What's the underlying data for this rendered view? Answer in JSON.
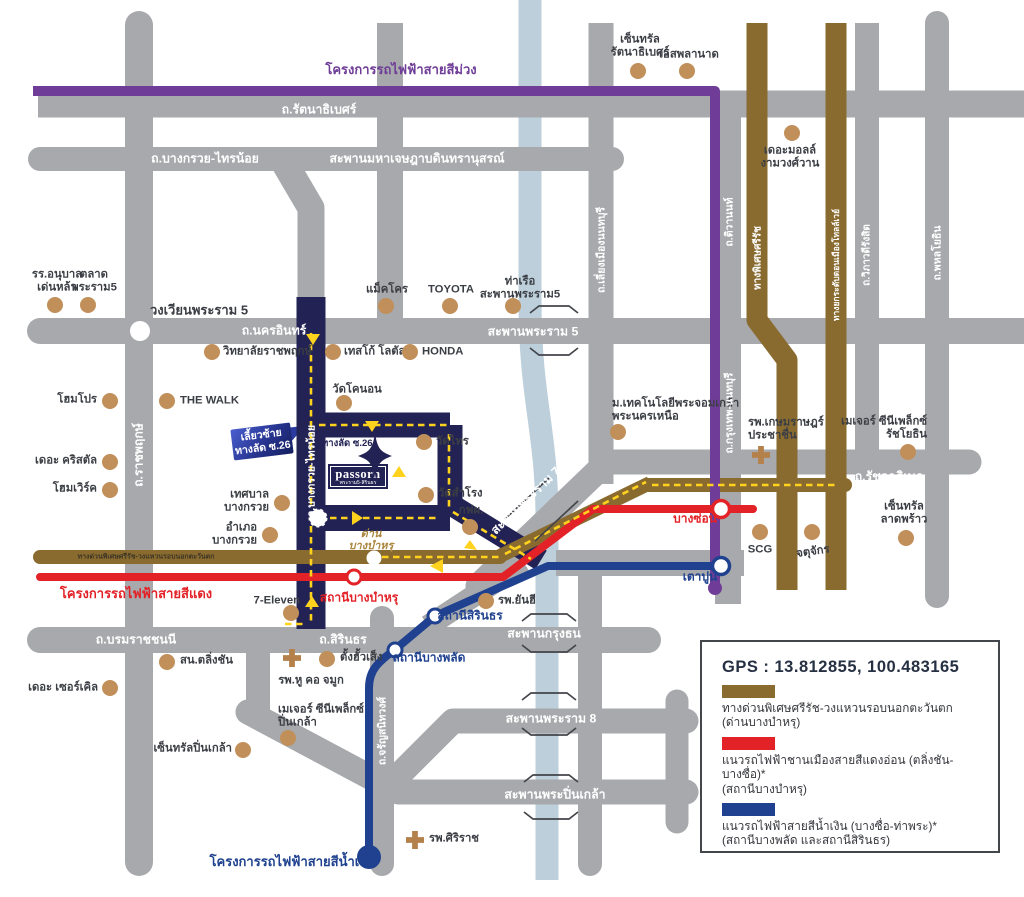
{
  "colors": {
    "road_gray": "#a7a9ac",
    "road_navy": "#222254",
    "expressway_brown": "#8a6b2f",
    "red_line": "#e32228",
    "blue_line": "#1f418f",
    "purple_line": "#6f3d97",
    "river": "#bccfda",
    "poi_dot": "#c18f5a",
    "gold": "#ab873e",
    "route_yellow": "#ffd21e",
    "text_dark": "#3b3e44"
  },
  "legend": {
    "gps": "GPS : 13.812855, 100.483165",
    "items": [
      {
        "color": "#8a6b2f",
        "text": "ทางด่วนพิเศษศรีรัช-วงแหวนรอบนอกตะวันตก\n(ด่านบางบำหรุ)"
      },
      {
        "color": "#e32228",
        "text": "แนวรถไฟฟ้าชานเมืองสายสีแดงอ่อน (ตลิ่งชัน-บางซื่อ)*\n(สถานีบางบำหรุ)"
      },
      {
        "color": "#1f418f",
        "text": "แนวรถไฟฟ้าสายสีน้ำเงิน (บางซื่อ-ท่าพระ)*\n(สถานีบางพลัด และสถานีสิรินธร)"
      }
    ]
  },
  "logo": {
    "name": "passorn",
    "subtitle": "พระราม5-สิรินธร"
  },
  "callout": {
    "line1": "เลี้ยวซ้าย",
    "line2": "ทางลัด ซ.26"
  },
  "shortcut_road_label": "ทางลัด ซ.26",
  "road_labels": [
    {
      "t": "ถ.รัตนาธิเบศร์",
      "x": 319,
      "y": 110
    },
    {
      "t": "ถ.บางกรวย-ไทรน้อย",
      "x": 205,
      "y": 159
    },
    {
      "t": "สะพานมหาเจษฎาบดินทรานุสรณ์",
      "x": 417,
      "y": 159
    },
    {
      "t": "วงเวียนพระราม 5",
      "x": 199,
      "y": 310,
      "c": "#3b3e44",
      "fs": 13
    },
    {
      "t": "ถ.นครอินทร์",
      "x": 274,
      "y": 331
    },
    {
      "t": "สะพานพระราม 5",
      "x": 533,
      "y": 332
    },
    {
      "t": "ถ.รัชดาภิเษก",
      "x": 889,
      "y": 477
    },
    {
      "t": "ถ.บรมราชชนนี",
      "x": 136,
      "y": 640
    },
    {
      "t": "ถ.สิรินธร",
      "x": 343,
      "y": 640
    },
    {
      "t": "สะพานกรุงธน",
      "x": 544,
      "y": 634
    },
    {
      "t": "สะพานพระราม 8",
      "x": 551,
      "y": 719
    },
    {
      "t": "สะพานพระปิ่นเกล้า",
      "x": 555,
      "y": 795
    },
    {
      "t": "สะพานพระราม 7",
      "x": 526,
      "y": 501,
      "rot": -44
    },
    {
      "t": "ถ.ราชพฤกษ์",
      "x": 139,
      "y": 455,
      "rot": -90
    },
    {
      "t": "ถ.บางกรวย-ไทรน้อย",
      "x": 311,
      "y": 471,
      "rot": -90,
      "fs": 10.5
    },
    {
      "t": "ถ.เลี่ยงเมืองนนทบุรี",
      "x": 601,
      "y": 250,
      "rot": -90,
      "fs": 10.5
    },
    {
      "t": "ถ.ติวานนท์",
      "x": 729,
      "y": 222,
      "rot": -90,
      "fs": 10.5
    },
    {
      "t": "ถ.กรุงเทพ-นนทบุรี",
      "x": 729,
      "y": 413,
      "rot": -90,
      "fs": 10.5
    },
    {
      "t": "ทางพิเศษศรีรัช",
      "x": 758,
      "y": 258,
      "rot": -90,
      "fs": 10
    },
    {
      "t": "ทางยกระดับดอนเมืองโทลล์เวย์",
      "x": 836,
      "y": 265,
      "rot": -90,
      "fs": 8.5
    },
    {
      "t": "ถ.วิภาวดีรังสิต",
      "x": 867,
      "y": 255,
      "rot": -90,
      "fs": 10
    },
    {
      "t": "ถ.พหลโยธิน",
      "x": 937,
      "y": 253,
      "rot": -90,
      "fs": 10.5
    },
    {
      "t": "ถ.จรัญสนิทวงศ์",
      "x": 382,
      "y": 731,
      "rot": -90,
      "fs": 10.5
    },
    {
      "t": "ทางด่วนพิเศษศรีรัช-วงแหวนรอบนอกตะวันตก",
      "x": 146,
      "y": 557,
      "c": "#3c3526",
      "fs": 7
    }
  ],
  "transit_labels": [
    {
      "t": "โครงการรถไฟฟ้าสายสีม่วง",
      "x": 401,
      "y": 70,
      "c": "#6f3d97",
      "fs": 13
    },
    {
      "t": "โครงการรถไฟฟ้าสายสีแดง",
      "x": 136,
      "y": 594,
      "c": "#e32228",
      "fs": 13
    },
    {
      "t": "โครงการรถไฟฟ้าสายสีน้ำเงิน",
      "x": 292,
      "y": 862,
      "c": "#1f418f",
      "fs": 13
    },
    {
      "t": "บางซ่อน",
      "x": 695,
      "y": 519,
      "c": "#e32228"
    },
    {
      "t": "เตาปูน",
      "x": 700,
      "y": 577,
      "c": "#1f418f"
    },
    {
      "t": "สถานีบางบำหรุ",
      "x": 359,
      "y": 598,
      "c": "#e32228"
    },
    {
      "t": "สถานีสิรินธร",
      "x": 470,
      "y": 616,
      "c": "#1f418f"
    },
    {
      "t": "สถานีบางพลัด",
      "x": 429,
      "y": 658,
      "c": "#1f418f"
    },
    {
      "t": "ด่าน\nบางบำหรุ",
      "x": 371,
      "y": 540,
      "c": "#ab873e",
      "fs": 11,
      "i": true
    }
  ],
  "pois": [
    {
      "t": "รร.อนุบาล\nเด่นหล้า",
      "x": 55,
      "y": 305,
      "lx": 57,
      "ly": 281,
      "a": "c"
    },
    {
      "t": "ตลาด\nพระราม5",
      "x": 88,
      "y": 305,
      "lx": 94,
      "ly": 281,
      "a": "c"
    },
    {
      "t": "แม็คโคร",
      "x": 386,
      "y": 306,
      "lx": 387,
      "ly": 290,
      "a": "c"
    },
    {
      "t": "TOYOTA",
      "x": 450,
      "y": 306,
      "lx": 451,
      "ly": 290,
      "a": "c"
    },
    {
      "t": "ท่าเรือ\nสะพานพระราม5",
      "x": 513,
      "y": 306,
      "lx": 520,
      "ly": 288,
      "a": "c"
    },
    {
      "t": "เซ็นทรัล\nรัตนาธิเบศร์",
      "x": 638,
      "y": 71,
      "lx": 640,
      "ly": 46,
      "a": "c"
    },
    {
      "t": "เอสพลานาด",
      "x": 687,
      "y": 71,
      "lx": 689,
      "ly": 55,
      "a": "c"
    },
    {
      "t": "เดอะมอลล์\nงามวงศ์วาน",
      "x": 792,
      "y": 133,
      "lx": 790,
      "ly": 157,
      "a": "c"
    },
    {
      "t": "วิทยาลัยราชพฤกษ์",
      "x": 212,
      "y": 352,
      "lx": 223,
      "ly": 352,
      "a": "l"
    },
    {
      "t": "เทสโก้ โลตัส",
      "x": 333,
      "y": 352,
      "lx": 344,
      "ly": 352,
      "a": "l"
    },
    {
      "t": "HONDA",
      "x": 410,
      "y": 352,
      "lx": 422,
      "ly": 352,
      "a": "l"
    },
    {
      "t": "วัดโคนอน",
      "x": 344,
      "y": 403,
      "lx": 357,
      "ly": 390,
      "a": "c"
    },
    {
      "t": "โฮมโปร",
      "x": 110,
      "y": 401,
      "lx": 97,
      "ly": 400,
      "a": "r"
    },
    {
      "t": "THE WALK",
      "x": 167,
      "y": 401,
      "lx": 180,
      "ly": 401,
      "a": "l"
    },
    {
      "t": "เดอะ คริสตัล",
      "x": 110,
      "y": 462,
      "lx": 97,
      "ly": 461,
      "a": "r"
    },
    {
      "t": "โฮมเวิร์ค",
      "x": 110,
      "y": 490,
      "lx": 97,
      "ly": 489,
      "a": "r"
    },
    {
      "t": "เทศบาล\nบางกรวย",
      "x": 282,
      "y": 503,
      "lx": 269,
      "ly": 501,
      "a": "r"
    },
    {
      "t": "อำเภอ\nบางกรวย",
      "x": 270,
      "y": 535,
      "lx": 257,
      "ly": 534,
      "a": "r"
    },
    {
      "t": "วัดไทร",
      "x": 424,
      "y": 442,
      "lx": 436,
      "ly": 442,
      "a": "l"
    },
    {
      "t": "วัดสำโรง",
      "x": 426,
      "y": 495,
      "lx": 438,
      "ly": 494,
      "a": "l"
    },
    {
      "t": "กฟผ.",
      "x": 470,
      "y": 527,
      "lx": 471,
      "ly": 511,
      "a": "c"
    },
    {
      "t": "ม.เทคโนโลยีพระจอมเกล้า\nพระนครเหนือ",
      "x": 618,
      "y": 432,
      "lx": 612,
      "ly": 410,
      "a": "l"
    },
    {
      "t": "รพ.เกษมราษฎร์\nประชาชื่น",
      "x": 761,
      "y": 455,
      "lx": 748,
      "ly": 429,
      "a": "l",
      "type": "cross"
    },
    {
      "t": "เมเจอร์ ซีนีเพล็กซ์\nรัชโยธิน",
      "x": 908,
      "y": 452,
      "lx": 927,
      "ly": 428,
      "a": "r"
    },
    {
      "t": "เซ็นทรัล\nลาดพร้าว",
      "x": 906,
      "y": 538,
      "lx": 904,
      "ly": 513,
      "a": "c"
    },
    {
      "t": "SCG",
      "x": 760,
      "y": 532,
      "lx": 760,
      "ly": 550,
      "a": "c"
    },
    {
      "t": "จตุจักร",
      "x": 812,
      "y": 532,
      "lx": 813,
      "ly": 552,
      "a": "c",
      "rot": -8
    },
    {
      "t": "7-Eleven",
      "x": 291,
      "y": 613,
      "lx": 300,
      "ly": 601,
      "a": "r"
    },
    {
      "t": "รพ.ยันฮี",
      "x": 486,
      "y": 601,
      "lx": 498,
      "ly": 601,
      "a": "l"
    },
    {
      "t": "สน.ตลิ่งชัน",
      "x": 167,
      "y": 662,
      "lx": 180,
      "ly": 661,
      "a": "l"
    },
    {
      "t": "เดอะ เซอร์เคิล",
      "x": 110,
      "y": 688,
      "lx": 98,
      "ly": 688,
      "a": "r"
    },
    {
      "t": "ตั้งฮั้วเส็ง",
      "x": 327,
      "y": 659,
      "lx": 340,
      "ly": 658,
      "a": "l"
    },
    {
      "t": "รพ.หู คอ จมูก",
      "x": 292,
      "y": 658,
      "lx": 311,
      "ly": 681,
      "a": "c",
      "type": "cross"
    },
    {
      "t": "เมเจอร์ ซีนีเพล็กซ์\nปิ่นเกล้า",
      "x": 288,
      "y": 738,
      "lx": 278,
      "ly": 716,
      "a": "l"
    },
    {
      "t": "เซ็นทรัลปิ่นเกล้า",
      "x": 243,
      "y": 750,
      "lx": 232,
      "ly": 749,
      "a": "r"
    },
    {
      "t": "รพ.ศิริราช",
      "x": 415,
      "y": 840,
      "lx": 429,
      "ly": 839,
      "a": "l",
      "type": "cross"
    }
  ]
}
